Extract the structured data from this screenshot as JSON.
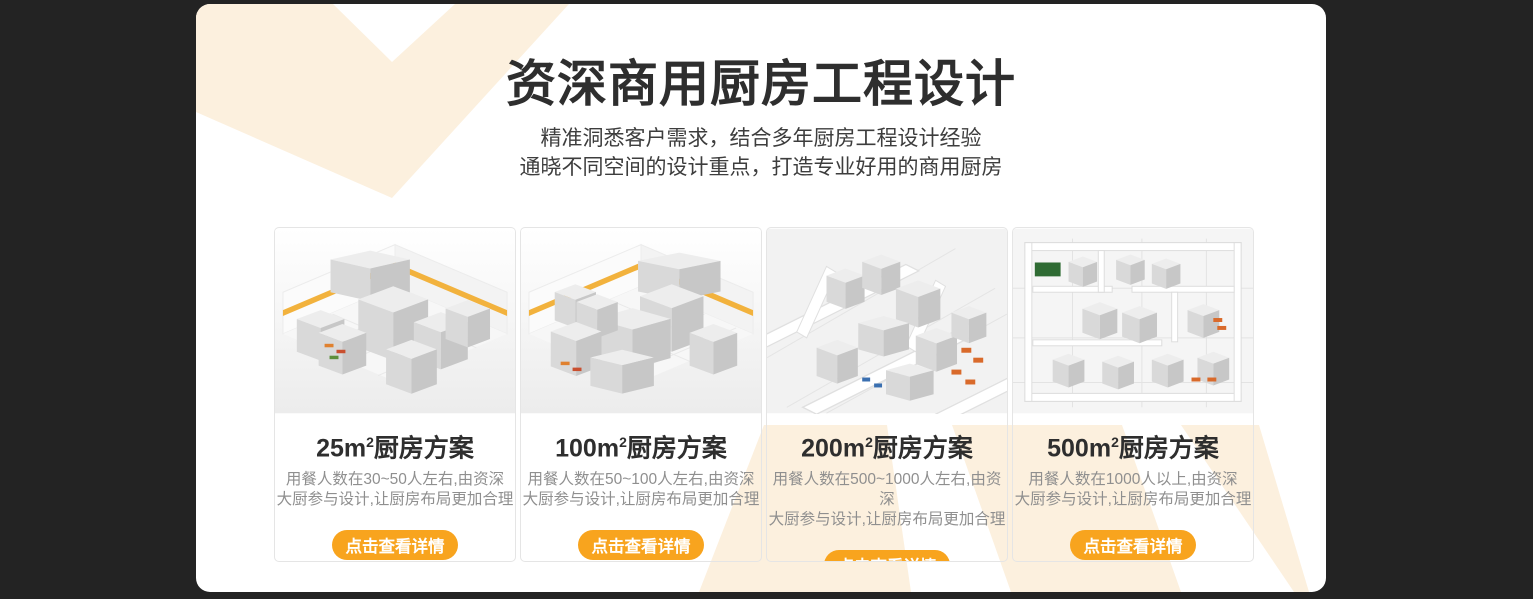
{
  "page": {
    "background_color": "#232323",
    "panel_color": "#ffffff",
    "watermark_color": "#fcf0de",
    "accent_color": "#f8a41e"
  },
  "header": {
    "title": "资深商用厨房工程设计",
    "subtitle_line1": "精准洞悉客户需求，结合多年厨房工程设计经验",
    "subtitle_line2": "通晓不同空间的设计重点，打造专业好用的商用厨房"
  },
  "cards": [
    {
      "size": "25m",
      "sup": "2",
      "suffix": "厨房方案",
      "desc_line1": "用餐人数在30~50人左右,由资深",
      "desc_line2": "大厨参与设计,让厨房布局更加合理",
      "button_label": "点击查看详情",
      "image": "kitchen-isometric-render-25sqm"
    },
    {
      "size": "100m",
      "sup": "2",
      "suffix": "厨房方案",
      "desc_line1": "用餐人数在50~100人左右,由资深",
      "desc_line2": "大厨参与设计,让厨房布局更加合理",
      "button_label": "点击查看详情",
      "image": "kitchen-isometric-render-100sqm"
    },
    {
      "size": "200m",
      "sup": "2",
      "suffix": "厨房方案",
      "desc_line1": "用餐人数在500~1000人左右,由资深",
      "desc_line2": "大厨参与设计,让厨房布局更加合理",
      "button_label": "点击查看详情",
      "image": "kitchen-isometric-render-200sqm"
    },
    {
      "size": "500m",
      "sup": "2",
      "suffix": "厨房方案",
      "desc_line1": "用餐人数在1000人以上,由资深",
      "desc_line2": "大厨参与设计,让厨房布局更加合理",
      "button_label": "点击查看详情",
      "image": "kitchen-isometric-render-500sqm"
    }
  ]
}
